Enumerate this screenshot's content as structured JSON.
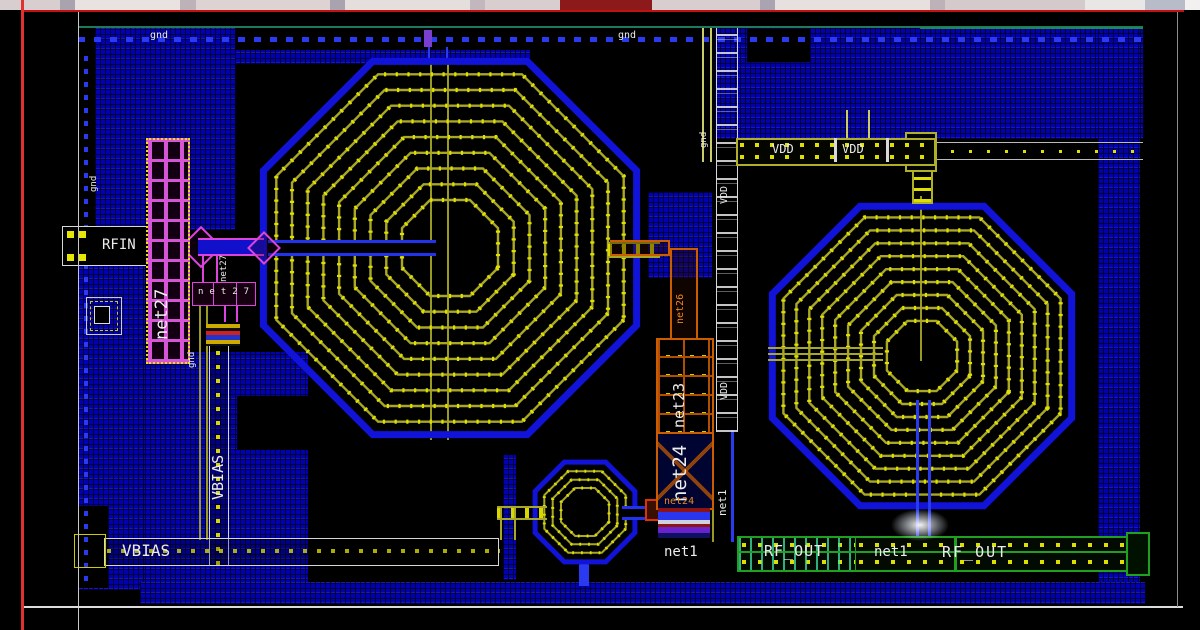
{
  "app": {
    "description": "IC layout editor canvas fragment showing an RF amplifier layout with spiral inductors"
  },
  "labels": {
    "gnd1": "gnd",
    "gnd2": "gnd",
    "gnd3": "gnd",
    "gnd4": "gnd",
    "gnd5": "gnd",
    "rfin": "RFIN",
    "net27_cap": "net27",
    "net27_trace": "net27",
    "net27_row": "net27",
    "vbias_v": "VBIAS",
    "vbias_h": "VBIAS",
    "net26": "net26",
    "net23": "net23",
    "net24_box": "net24",
    "net24_small": "net24",
    "vdd_rail_a": "VDD",
    "vdd_rail_b": "VDD",
    "vdd_col_a": "VDD",
    "vdd_col_b": "VDD",
    "net1_col": "net1",
    "net1_left": "net1",
    "net1_mid": "net1",
    "rfout_a": "RF_OUT",
    "rfout_b": "RF_OUT"
  },
  "colors": {
    "ground_hatch_blue": "#0101b0",
    "metal_yellow": "#a8a826",
    "via_yellow": "#e6e600",
    "capacitor_magenta": "#d655d6",
    "transistor_orange": "#cc5c00",
    "rfout_green": "#1fa01f",
    "rfout_cyan": "#3ce6aa",
    "rail_blue": "#2a3af0",
    "teal_rail": "#1d7a5f",
    "frame_red": "#c01212",
    "label_white": "#ececec"
  }
}
